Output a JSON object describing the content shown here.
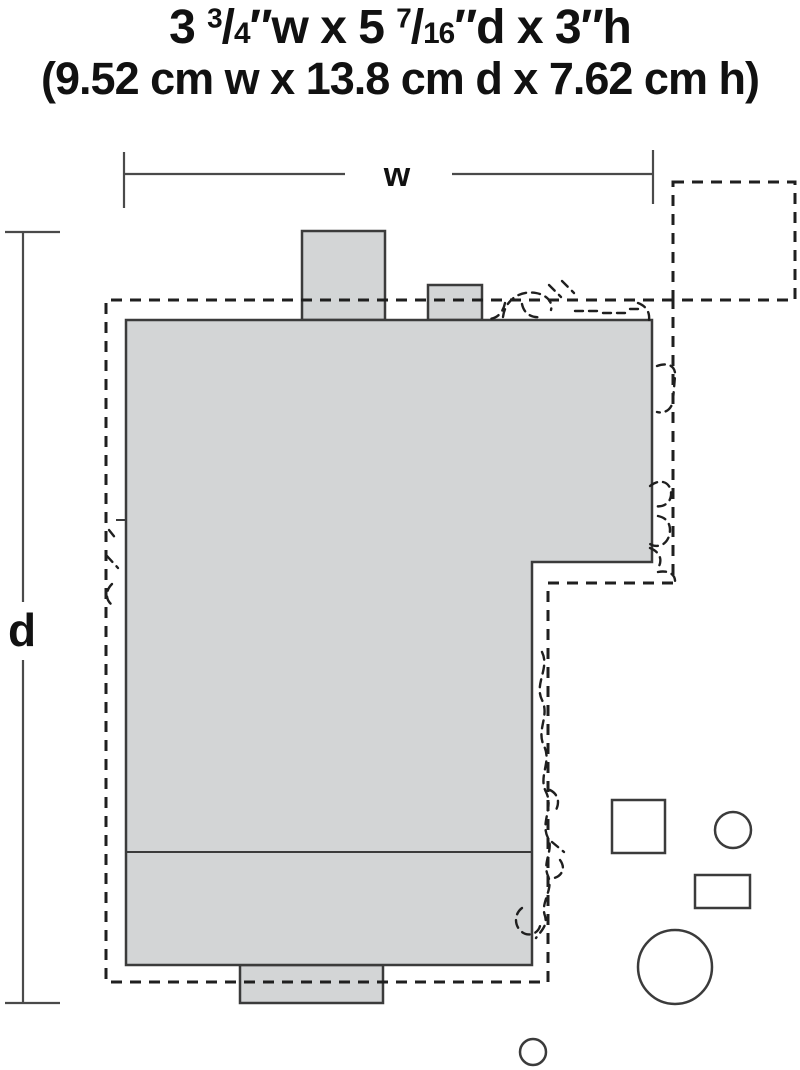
{
  "title": {
    "line1_segments": [
      {
        "text": "3 ",
        "style": "normal"
      },
      {
        "text": "3",
        "style": "sup"
      },
      {
        "text": "/",
        "style": "normal"
      },
      {
        "text": "4",
        "style": "small"
      },
      {
        "text": "″w x 5 ",
        "style": "normal"
      },
      {
        "text": "7",
        "style": "sup"
      },
      {
        "text": "/",
        "style": "normal"
      },
      {
        "text": "16",
        "style": "small"
      },
      {
        "text": "″d x 3″h",
        "style": "normal"
      }
    ],
    "line1_plain": "3 3/4″w x 5 7/16″d x 3″h",
    "line2": "(9.52 cm w x 13.8 cm d x 7.62 cm h)"
  },
  "labels": {
    "width": "w",
    "depth": "d"
  },
  "colors": {
    "background": "#ffffff",
    "shape_fill": "#d3d5d6",
    "shape_stroke": "#3b3b3b",
    "dash_stroke": "#1f1f1f",
    "dim_stroke": "#4a4a4a",
    "text": "#111111"
  }
}
